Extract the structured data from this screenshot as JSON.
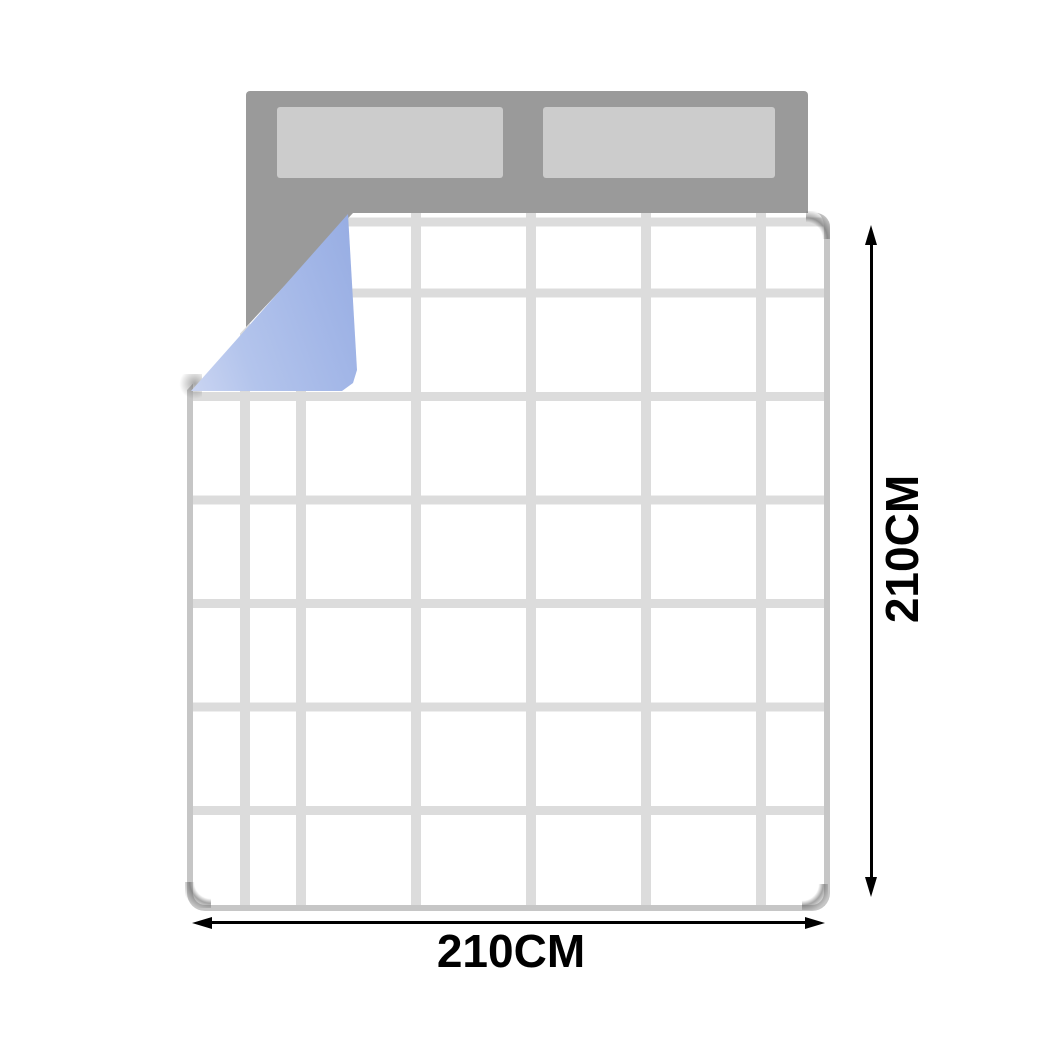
{
  "diagram": {
    "type": "bedding-size-diagram",
    "subject": "quilt-on-bed-top-view",
    "width_label": "210CM",
    "height_label": "210CM",
    "colors": {
      "bed_gray": "#9a9a9a",
      "pillow_gray": "#cccccc",
      "quilt_white": "#ffffff",
      "quilt_grid_line": "#dcdcdc",
      "quilt_border": "#c6c6c6",
      "fold_underside_blue": "#a9bde9",
      "dimension_line_black": "#000000"
    },
    "grid": {
      "columns": 6,
      "rows": 7
    }
  }
}
